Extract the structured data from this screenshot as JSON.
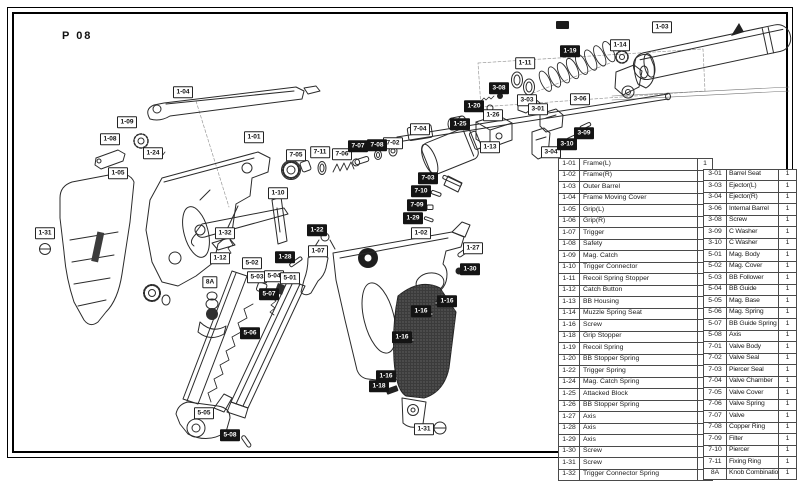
{
  "page": {
    "title": "P 08"
  },
  "colors": {
    "ink": "#2b2b2b",
    "label_black_bg": "#141414",
    "grip_fill": "#3b3b3b",
    "page_bg": "#ffffff"
  },
  "diagram": {
    "labels": [
      {
        "text": "1-04",
        "x": 183,
        "y": 92,
        "style": "white"
      },
      {
        "text": "1-09",
        "x": 127,
        "y": 122,
        "style": "white"
      },
      {
        "text": "1-08",
        "x": 110,
        "y": 139,
        "style": "white"
      },
      {
        "text": "1-24",
        "x": 153,
        "y": 153,
        "style": "white"
      },
      {
        "text": "1-01",
        "x": 254,
        "y": 137,
        "style": "white"
      },
      {
        "text": "1-05",
        "x": 118,
        "y": 173,
        "style": "white"
      },
      {
        "text": "1-31",
        "x": 45,
        "y": 233,
        "style": "white"
      },
      {
        "text": "1-10",
        "x": 278,
        "y": 193,
        "style": "white"
      },
      {
        "text": "1-32",
        "x": 225,
        "y": 233,
        "style": "white"
      },
      {
        "text": "1-12",
        "x": 220,
        "y": 258,
        "style": "white"
      },
      {
        "text": "8A",
        "x": 210,
        "y": 282,
        "style": "white"
      },
      {
        "text": "5-02",
        "x": 252,
        "y": 263,
        "style": "white"
      },
      {
        "text": "5-03",
        "x": 257,
        "y": 277,
        "style": "white"
      },
      {
        "text": "5-04",
        "x": 274,
        "y": 276,
        "style": "white"
      },
      {
        "text": "5-01",
        "x": 290,
        "y": 278,
        "style": "white"
      },
      {
        "text": "1-07",
        "x": 318,
        "y": 251,
        "style": "white"
      },
      {
        "text": "5-05",
        "x": 204,
        "y": 413,
        "style": "white"
      },
      {
        "text": "1-02",
        "x": 421,
        "y": 233,
        "style": "white"
      },
      {
        "text": "1-27",
        "x": 473,
        "y": 248,
        "style": "white"
      },
      {
        "text": "1-31",
        "x": 424,
        "y": 429,
        "style": "white"
      },
      {
        "text": "7-05",
        "x": 296,
        "y": 155,
        "style": "white"
      },
      {
        "text": "7-11",
        "x": 320,
        "y": 152,
        "style": "white"
      },
      {
        "text": "7-06",
        "x": 342,
        "y": 154,
        "style": "white"
      },
      {
        "text": "7-02",
        "x": 393,
        "y": 143,
        "style": "white"
      },
      {
        "text": "7-04",
        "x": 420,
        "y": 129,
        "style": "white"
      },
      {
        "text": "1-11",
        "x": 525,
        "y": 63,
        "style": "white"
      },
      {
        "text": "1-14",
        "x": 620,
        "y": 45,
        "style": "white"
      },
      {
        "text": "1-03",
        "x": 662,
        "y": 27,
        "style": "white"
      },
      {
        "text": "3-03",
        "x": 527,
        "y": 100,
        "style": "white"
      },
      {
        "text": "3-01",
        "x": 538,
        "y": 109,
        "style": "white"
      },
      {
        "text": "3-06",
        "x": 580,
        "y": 99,
        "style": "white"
      },
      {
        "text": "1-26",
        "x": 493,
        "y": 115,
        "style": "white"
      },
      {
        "text": "1-13",
        "x": 490,
        "y": 147,
        "style": "white"
      },
      {
        "text": "3-04",
        "x": 551,
        "y": 152,
        "style": "white"
      },
      {
        "text": "1-19",
        "x": 570,
        "y": 51,
        "style": "black"
      },
      {
        "text": "3-08",
        "x": 499,
        "y": 88,
        "style": "black"
      },
      {
        "text": "1-20",
        "x": 474,
        "y": 106,
        "style": "black"
      },
      {
        "text": "1-25",
        "x": 460,
        "y": 124,
        "style": "black"
      },
      {
        "text": "3-09",
        "x": 584,
        "y": 133,
        "style": "black"
      },
      {
        "text": "3-10",
        "x": 567,
        "y": 144,
        "style": "black"
      },
      {
        "text": "7-07",
        "x": 358,
        "y": 146,
        "style": "black"
      },
      {
        "text": "7-08",
        "x": 377,
        "y": 145,
        "style": "black"
      },
      {
        "text": "7-03",
        "x": 428,
        "y": 178,
        "style": "black"
      },
      {
        "text": "7-10",
        "x": 421,
        "y": 191,
        "style": "black"
      },
      {
        "text": "7-09",
        "x": 417,
        "y": 205,
        "style": "black"
      },
      {
        "text": "1-29",
        "x": 413,
        "y": 218,
        "style": "black"
      },
      {
        "text": "1-22",
        "x": 317,
        "y": 230,
        "style": "black"
      },
      {
        "text": "1-28",
        "x": 285,
        "y": 257,
        "style": "black"
      },
      {
        "text": "5-07",
        "x": 269,
        "y": 294,
        "style": "black"
      },
      {
        "text": "5-06",
        "x": 250,
        "y": 333,
        "style": "black"
      },
      {
        "text": "5-08",
        "x": 230,
        "y": 435,
        "style": "black"
      },
      {
        "text": "1-30",
        "x": 470,
        "y": 269,
        "style": "black"
      },
      {
        "text": "1-16",
        "x": 447,
        "y": 301,
        "style": "black"
      },
      {
        "text": "1-16",
        "x": 421,
        "y": 311,
        "style": "black"
      },
      {
        "text": "1-16",
        "x": 402,
        "y": 337,
        "style": "black"
      },
      {
        "text": "1-16",
        "x": 386,
        "y": 376,
        "style": "black"
      },
      {
        "text": "1-18",
        "x": 379,
        "y": 386,
        "style": "black"
      }
    ]
  },
  "parts_table": {
    "left": [
      {
        "no": "1-01",
        "name": "Frame(L)",
        "qty": "1"
      },
      {
        "no": "1-02",
        "name": "Frame(R)",
        "qty": "1"
      },
      {
        "no": "1-03",
        "name": "Outer Barrel",
        "qty": "1"
      },
      {
        "no": "1-04",
        "name": "Frame Moving Cover",
        "qty": "1"
      },
      {
        "no": "1-05",
        "name": "Grip(L)",
        "qty": "1"
      },
      {
        "no": "1-06",
        "name": "Grip(R)",
        "qty": "1"
      },
      {
        "no": "1-07",
        "name": "Trigger",
        "qty": "1"
      },
      {
        "no": "1-08",
        "name": "Safety",
        "qty": "1"
      },
      {
        "no": "1-09",
        "name": "Mag. Catch",
        "qty": "1"
      },
      {
        "no": "1-10",
        "name": "Trigger Connector",
        "qty": "1"
      },
      {
        "no": "1-11",
        "name": "Recoil Spring Stopper",
        "qty": "1"
      },
      {
        "no": "1-12",
        "name": "Catch Button",
        "qty": "1"
      },
      {
        "no": "1-13",
        "name": "BB Housing",
        "qty": "1"
      },
      {
        "no": "1-14",
        "name": "Muzzle Spring Seat",
        "qty": "1"
      },
      {
        "no": "1-16",
        "name": "Screw",
        "qty": "5"
      },
      {
        "no": "1-18",
        "name": "Grip Stopper",
        "qty": "1"
      },
      {
        "no": "1-19",
        "name": "Recoil Spring",
        "qty": "1"
      },
      {
        "no": "1-20",
        "name": "BB Stopper Spring",
        "qty": "1"
      },
      {
        "no": "1-22",
        "name": "Trigger Spring",
        "qty": "1"
      },
      {
        "no": "1-24",
        "name": "Mag. Catch Spring",
        "qty": "1"
      },
      {
        "no": "1-25",
        "name": "Attacked Block",
        "qty": "1"
      },
      {
        "no": "1-26",
        "name": "BB Stopper Spring",
        "qty": "1"
      },
      {
        "no": "1-27",
        "name": "Axis",
        "qty": "1"
      },
      {
        "no": "1-28",
        "name": "Axis",
        "qty": "1"
      },
      {
        "no": "1-29",
        "name": "Axis",
        "qty": "1"
      },
      {
        "no": "1-30",
        "name": "Screw",
        "qty": "1"
      },
      {
        "no": "1-31",
        "name": "Screw",
        "qty": "2"
      },
      {
        "no": "1-32",
        "name": "Trigger Connector Spring",
        "qty": "1"
      }
    ],
    "right": [
      {
        "no": "3-01",
        "name": "Barrel Seat",
        "qty": "1"
      },
      {
        "no": "3-03",
        "name": "Ejector(L)",
        "qty": "1"
      },
      {
        "no": "3-04",
        "name": "Ejector(R)",
        "qty": "1"
      },
      {
        "no": "3-06",
        "name": "Internal Barrel",
        "qty": "1"
      },
      {
        "no": "3-08",
        "name": "Screw",
        "qty": "1"
      },
      {
        "no": "3-09",
        "name": "C Washer",
        "qty": "1"
      },
      {
        "no": "3-10",
        "name": "C Washer",
        "qty": "1"
      },
      {
        "no": "5-01",
        "name": "Mag. Body",
        "qty": "1"
      },
      {
        "no": "5-02",
        "name": "Mag. Cover",
        "qty": "1"
      },
      {
        "no": "5-03",
        "name": "BB Follower",
        "qty": "1"
      },
      {
        "no": "5-04",
        "name": "BB Guide",
        "qty": "1"
      },
      {
        "no": "5-05",
        "name": "Mag. Base",
        "qty": "1"
      },
      {
        "no": "5-06",
        "name": "Mag. Spring",
        "qty": "1"
      },
      {
        "no": "5-07",
        "name": "BB Guide Spring",
        "qty": "1"
      },
      {
        "no": "5-08",
        "name": "Axis",
        "qty": "1"
      },
      {
        "no": "7-01",
        "name": "Valve Body",
        "qty": "1"
      },
      {
        "no": "7-02",
        "name": "Valve Seal",
        "qty": "1"
      },
      {
        "no": "7-03",
        "name": "Piercer Seal",
        "qty": "1"
      },
      {
        "no": "7-04",
        "name": "Valve Chamber",
        "qty": "1"
      },
      {
        "no": "7-05",
        "name": "Valve Cover",
        "qty": "1"
      },
      {
        "no": "7-06",
        "name": "Valve Spring",
        "qty": "1"
      },
      {
        "no": "7-07",
        "name": "Valve",
        "qty": "1"
      },
      {
        "no": "7-08",
        "name": "Copper Ring",
        "qty": "1"
      },
      {
        "no": "7-09",
        "name": "Filter",
        "qty": "1"
      },
      {
        "no": "7-10",
        "name": "Piercer",
        "qty": "1"
      },
      {
        "no": "7-11",
        "name": "Fixing Ring",
        "qty": "1"
      },
      {
        "no": "8A",
        "name": "Knob Combination",
        "qty": "1"
      }
    ]
  }
}
